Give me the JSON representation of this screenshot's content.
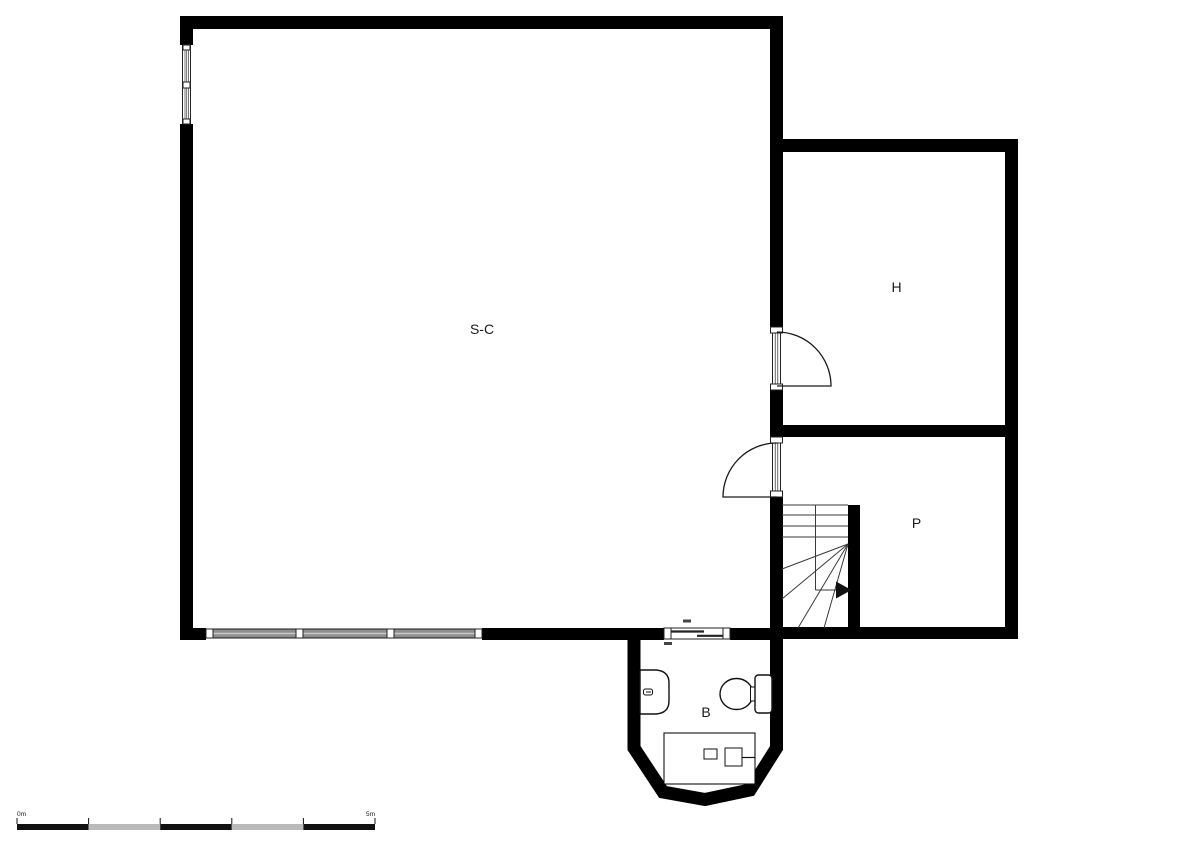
{
  "plan": {
    "rooms": [
      {
        "id": "main-room",
        "label": "S-C"
      },
      {
        "id": "room-h",
        "label": "H"
      },
      {
        "id": "room-p",
        "label": "P"
      },
      {
        "id": "bathroom",
        "label": "B"
      }
    ],
    "scale_bar": {
      "start_label": "0m",
      "end_label": "5m"
    },
    "colors": {
      "wall": "#000000",
      "stair_line": "#3a3a3a",
      "fixture_line": "#111111",
      "door_line": "#1a1a1a",
      "glazing": "#8f8f8f",
      "window_frame": "#222222",
      "scale_alt": "#bababa",
      "scale_main": "#111111",
      "text": "#1a1a1a"
    }
  }
}
